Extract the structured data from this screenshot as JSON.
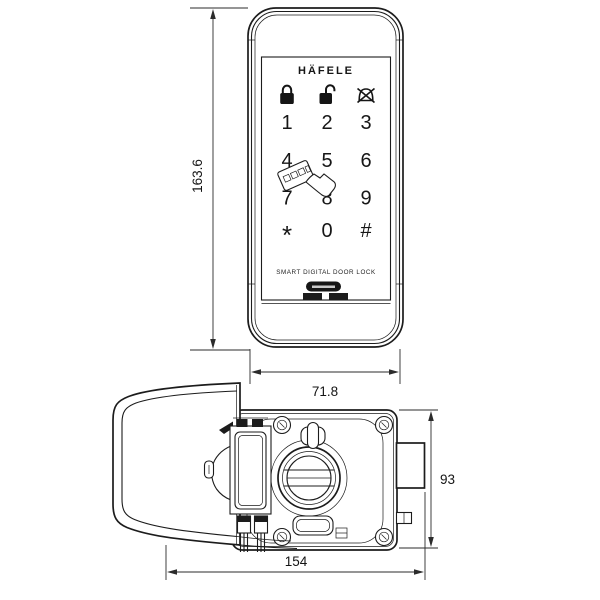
{
  "drawing": {
    "background": "#ffffff",
    "line_color": "#1c1c1c",
    "front_view": {
      "logo": "HÄFELE",
      "footer_label": "SMART DIGITAL DOOR LOCK",
      "keypad_keys": [
        "1",
        "2",
        "3",
        "4",
        "5",
        "6",
        "7",
        "8",
        "9",
        "*",
        "0",
        "#"
      ],
      "status_icons": [
        "lock-icon",
        "unlock-icon",
        "mute-bell-icon"
      ],
      "card_icon": "card-tap-hand-icon",
      "dim_height": "163.6",
      "dim_width": "71.8"
    },
    "side_view": {
      "dim_height": "93",
      "dim_depth": "154",
      "features": [
        "front-escutcheon-profile",
        "mounting-plate",
        "thumbturn-knob",
        "battery-holder",
        "corner-screws",
        "latch-bolt",
        "toggle-button"
      ]
    }
  }
}
